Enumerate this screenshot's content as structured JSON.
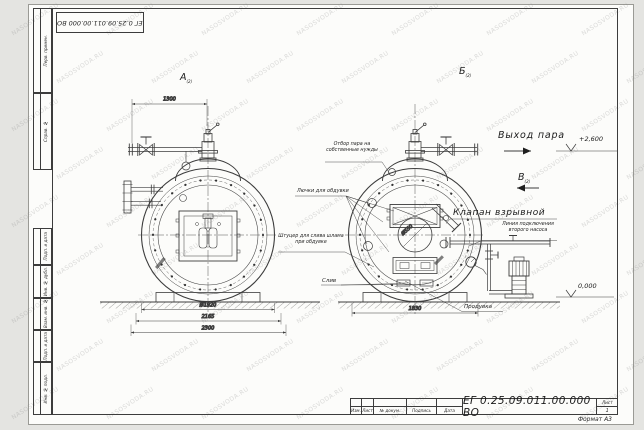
{
  "watermark": "NASOSVODA.RU",
  "stamp_top": {
    "doc_number": "ЕГ 0.25.09.011.00.000  ВО"
  },
  "frame_labels": {
    "perv": "Перв. примен.",
    "sprav": "Справ. №",
    "podp1": "Подп. и дата",
    "inv_dubl": "Инв. № дубл.",
    "vzam": "Взам. инв. №",
    "podp2": "Подп. и дата",
    "inv_podl": "Инв. № подл."
  },
  "views": {
    "a": {
      "label": "А",
      "scale": "(2)"
    },
    "b": {
      "label": "Б",
      "scale": "(2)"
    },
    "v": {
      "label": "В",
      "scale": "(2)"
    }
  },
  "annotations": {
    "steam_out": "Выход пара",
    "elev_top": "+2,600",
    "elev_zero": "0,000",
    "explosion_valve": "Клапан взрывной",
    "pump_line_1": "Линия подключения",
    "pump_line_2": "второго насоса",
    "steam_tap_1": "Отбор пара на",
    "steam_tap_2": "собственные нужды",
    "hatches": "Лючки для обдувки",
    "sludge_1": "Штуцер для слива шлама",
    "sludge_2": "при обдувке",
    "drain": "Слив",
    "blowdown": "Продувка"
  },
  "dimensions": {
    "top_left": "1300",
    "diameter": "Ø1920",
    "width_mid": "2165",
    "width_out": "2300",
    "right_width": "1830",
    "center_hole": "Ø550"
  },
  "title_block": {
    "doc_number": "ЕГ 0.25.09.011.00.000  ВО",
    "columns": [
      "Изм.",
      "Лист",
      "№ докум.",
      "Подпись",
      "Дата"
    ],
    "sheet_label": "Лист",
    "sheet_number": "1",
    "format": "Формат А3"
  }
}
